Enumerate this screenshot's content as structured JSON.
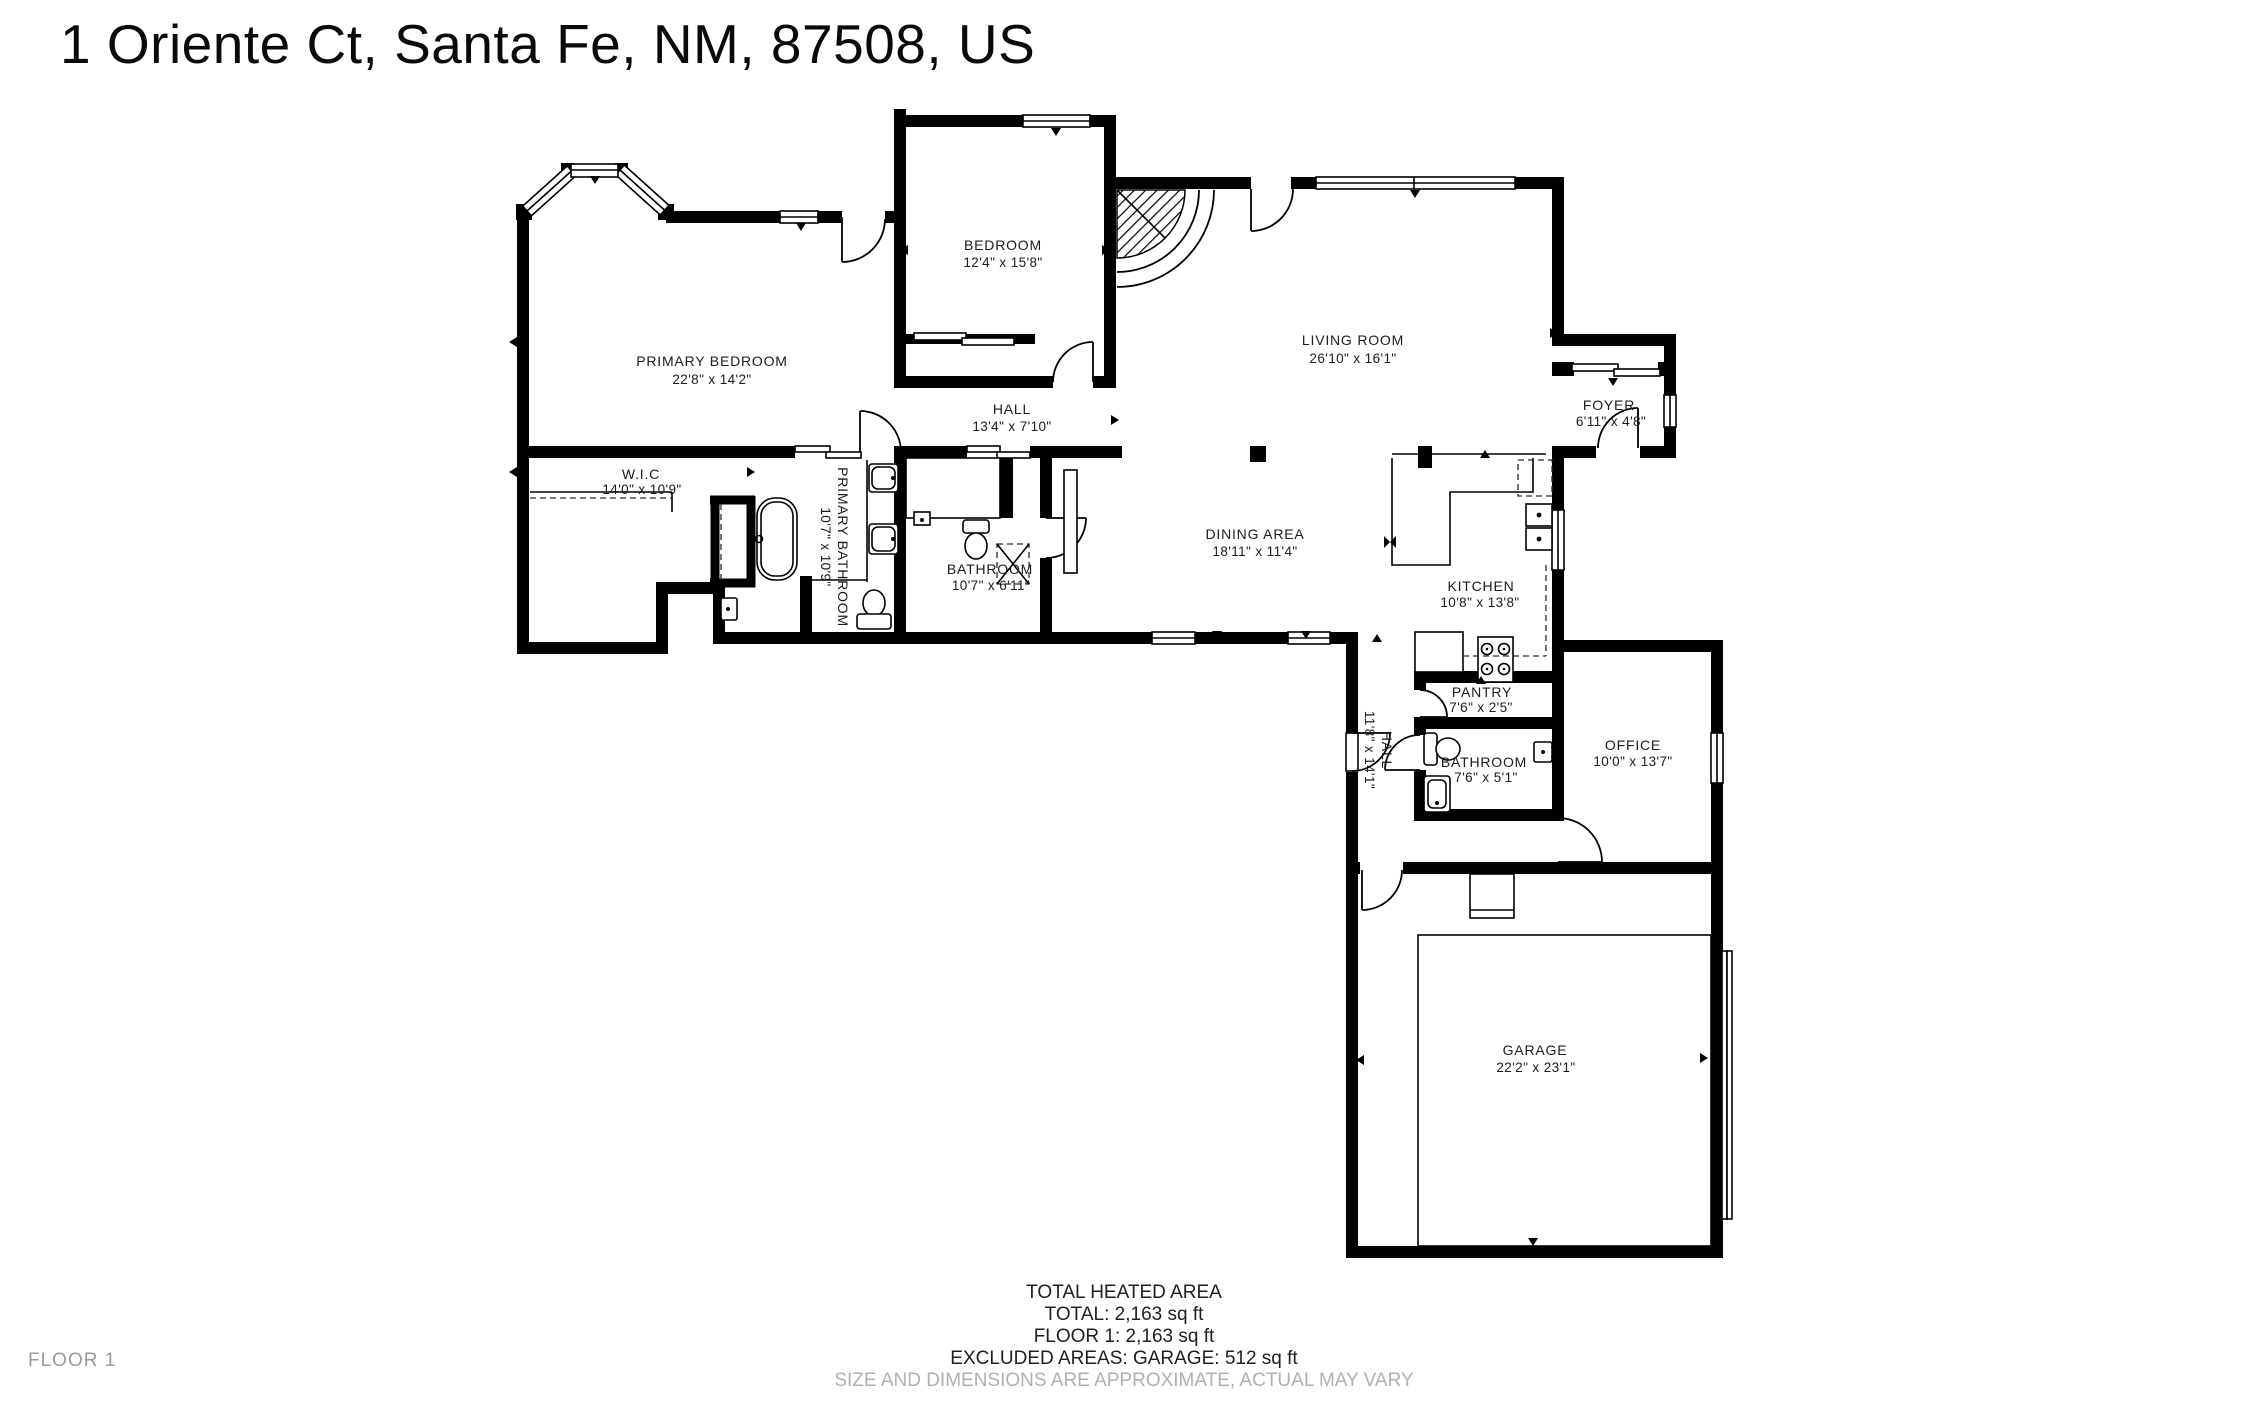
{
  "title": "1 Oriente Ct, Santa Fe, NM, 87508, US",
  "floor_label": "FLOOR 1",
  "footer": {
    "line1": "TOTAL HEATED AREA",
    "line2": "TOTAL: 2,163 sq ft",
    "line3": "FLOOR 1: 2,163 sq ft",
    "line4": "EXCLUDED AREAS: GARAGE: 512 sq ft",
    "disclaimer": "SIZE AND DIMENSIONS ARE APPROXIMATE, ACTUAL MAY VARY"
  },
  "rooms": [
    {
      "name": "PRIMARY BEDROOM",
      "dims": "22'8\" x 14'2\""
    },
    {
      "name": "BEDROOM",
      "dims": "12'4\" x 15'8\""
    },
    {
      "name": "LIVING ROOM",
      "dims": "26'10\" x 16'1\""
    },
    {
      "name": "HALL",
      "dims": "13'4\" x 7'10\""
    },
    {
      "name": "FOYER",
      "dims": "6'11\" x 4'8\""
    },
    {
      "name": "W.I.C",
      "dims": "14'0\" x 10'9\""
    },
    {
      "name": "PRIMARY BATHROOM",
      "dims": "10'7\" x 10'9\""
    },
    {
      "name": "BATHROOM",
      "dims": "10'7\" x 6'11\""
    },
    {
      "name": "DINING AREA",
      "dims": "18'11\" x 11'4\""
    },
    {
      "name": "KITCHEN",
      "dims": "10'8\" x 13'8\""
    },
    {
      "name": "PANTRY",
      "dims": "7'6\" x 2'5\""
    },
    {
      "name": "BATHROOM",
      "dims": "7'6\" x 5'1\""
    },
    {
      "name": "HALL",
      "dims": "11'8\" x 14'1\""
    },
    {
      "name": "OFFICE",
      "dims": "10'0\" x 13'7\""
    },
    {
      "name": "GARAGE",
      "dims": "22'2\" x 23'1\""
    }
  ]
}
